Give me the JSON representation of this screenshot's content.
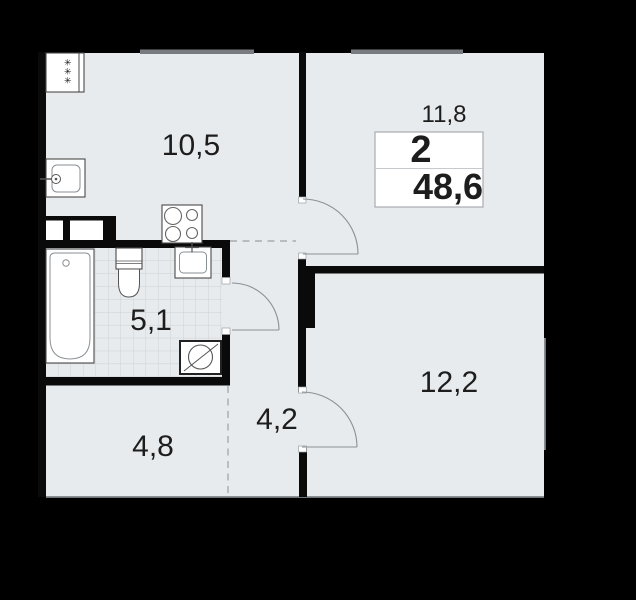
{
  "plan": {
    "type": "apartment-floor-plan",
    "apartment": {
      "rooms_count": "2",
      "total_area": "48,6"
    },
    "rooms": [
      {
        "id": "kitchen-living",
        "area": "10,5"
      },
      {
        "id": "bedroom",
        "area": "11,8"
      },
      {
        "id": "bathroom",
        "area": "5,1"
      },
      {
        "id": "hallway",
        "area": "4,2"
      },
      {
        "id": "entry",
        "area": "4,8"
      },
      {
        "id": "room-second",
        "area": "12,2"
      }
    ],
    "fridge_symbol": "✳✳✳",
    "icons": [
      "fridge-icon",
      "kitchen-sink-icon",
      "stove-icon",
      "ventilation-shaft",
      "bathtub-icon",
      "toilet-icon",
      "bathroom-sink-icon",
      "washing-machine-icon"
    ],
    "colors": {
      "background": "#000000",
      "floor": "#e8ebed",
      "walls": "#0a0a0a",
      "window_mark": "#787c80",
      "door_arc": "#8a9094",
      "text": "#1d1d1d",
      "tile_line": "#ccd1d4"
    }
  }
}
